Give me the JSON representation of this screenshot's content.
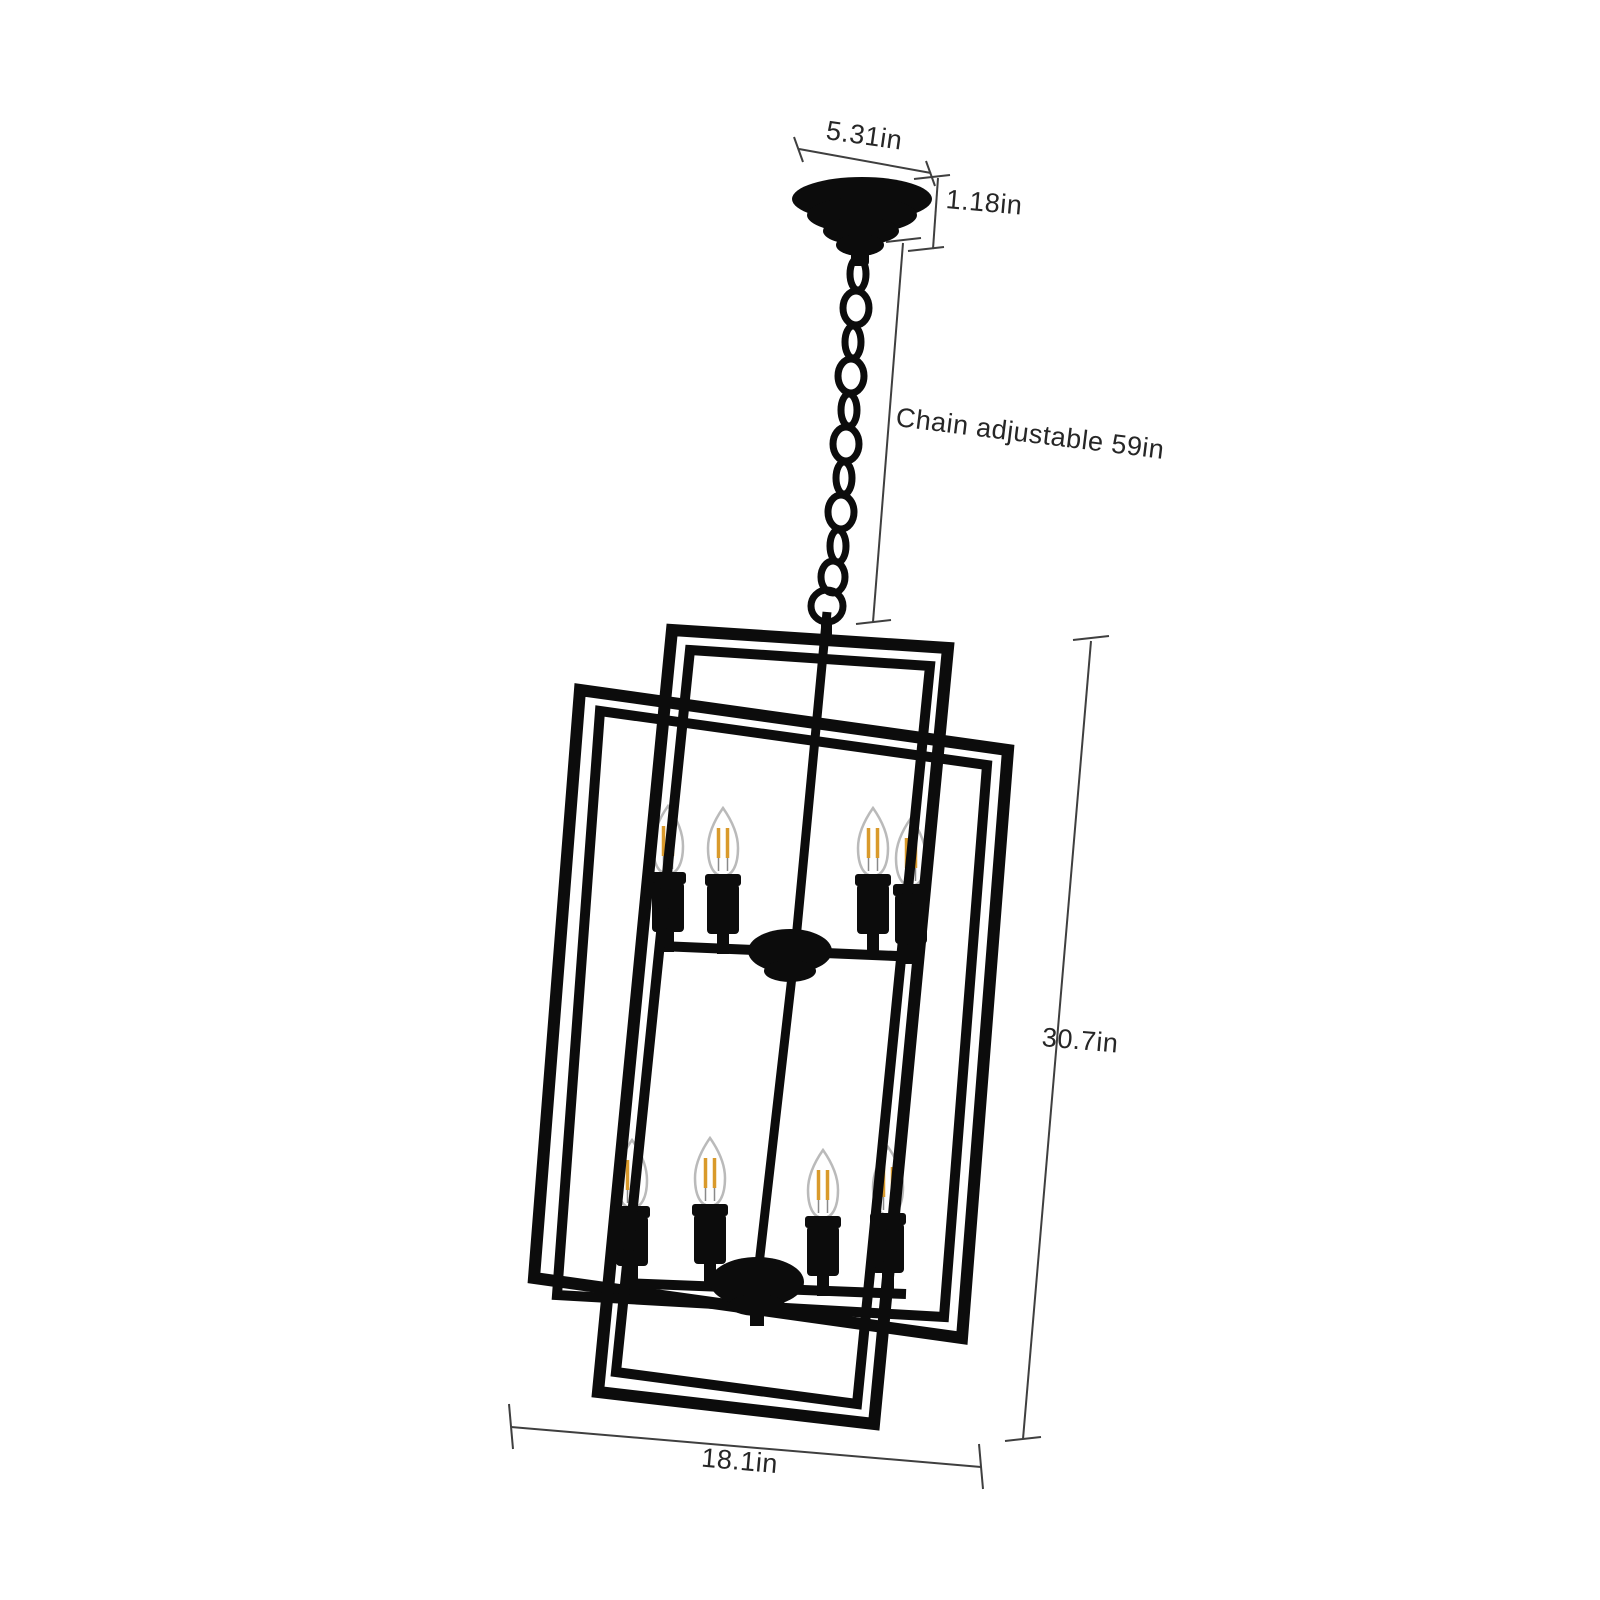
{
  "title": "Chandelier dimension diagram",
  "product": {
    "name": "8-light rectangular cage pendant chandelier",
    "bulb_count": 8,
    "bulb_type": "candelabra filament bulb",
    "tiers": 2,
    "bulbs_per_tier": 4
  },
  "dimensions": {
    "canopy_width": "5.31in",
    "canopy_height": "1.18in",
    "chain_length": "Chain adjustable 59in",
    "fixture_height": "30.7in",
    "fixture_width": "18.1in"
  },
  "colors": {
    "background": "#ffffff",
    "metal": "#0c0c0c",
    "dimension_line": "#3f3f3f",
    "label_text": "#262626",
    "filament": "#d99a2b",
    "glass_outline": "#bababa"
  }
}
